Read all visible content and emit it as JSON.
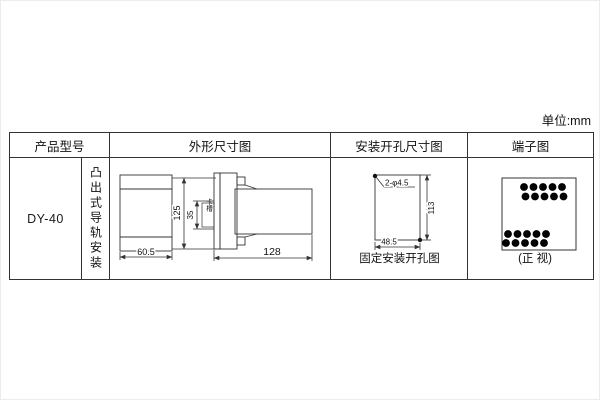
{
  "page": {
    "unit_label": "单位:mm"
  },
  "table": {
    "headers": {
      "product_model": "产品型号",
      "outline": "外形尺寸图",
      "mounting_holes": "安装开孔尺寸图",
      "terminals": "端子图"
    },
    "product": {
      "model": "DY-40",
      "mounting_type": "凸出式导轨安装"
    }
  },
  "outline_diagram": {
    "width": "60.5",
    "height": "125",
    "slot": "35",
    "slot_label": "卡槽",
    "depth": "128"
  },
  "hole_diagram": {
    "holes": "2-φ4.5",
    "height": "113",
    "width": "48.5",
    "caption": "固定安装开孔图"
  },
  "terminal_diagram": {
    "caption": "(正 视)",
    "top_rows": [
      [
        "11",
        "12",
        "13",
        "14",
        "15"
      ],
      [
        "16",
        "17",
        "18",
        "19",
        "20"
      ]
    ],
    "bottom_rows": [
      [
        "6",
        "7",
        "8",
        "9",
        "10"
      ],
      [
        "1",
        "2",
        "3",
        "4",
        "5"
      ]
    ]
  },
  "colors": {
    "line": "#333333",
    "text": "#1a1a1a",
    "bg": "#ffffff"
  }
}
